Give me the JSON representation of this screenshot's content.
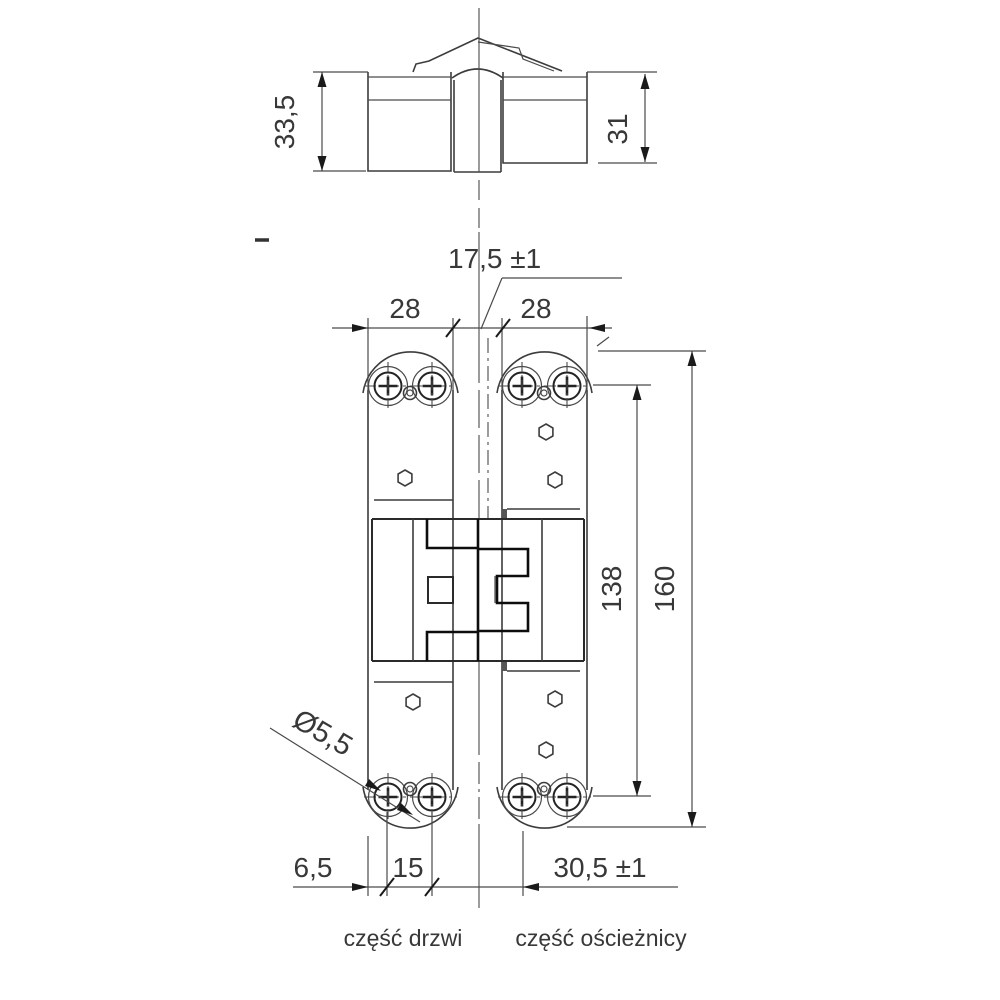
{
  "colors": {
    "background": "#ffffff",
    "line": "#3c3c3c",
    "line_bold": "#0d0d0d",
    "text": "#383838"
  },
  "top_view": {
    "height_left": "33,5",
    "height_right": "31"
  },
  "front_view": {
    "plate_width_left": "28",
    "plate_width_right": "28",
    "gap": "17,5 ±1",
    "screw_span": "138",
    "total_height": "160",
    "hole_diameter": "Ø5,5",
    "edge_to_screw": "6,5",
    "screw_spacing": "15",
    "gap_screw_distance": "30,5 ±1"
  },
  "captions": {
    "door_part": "część drzwi",
    "frame_part": "część ościeżnicy"
  }
}
